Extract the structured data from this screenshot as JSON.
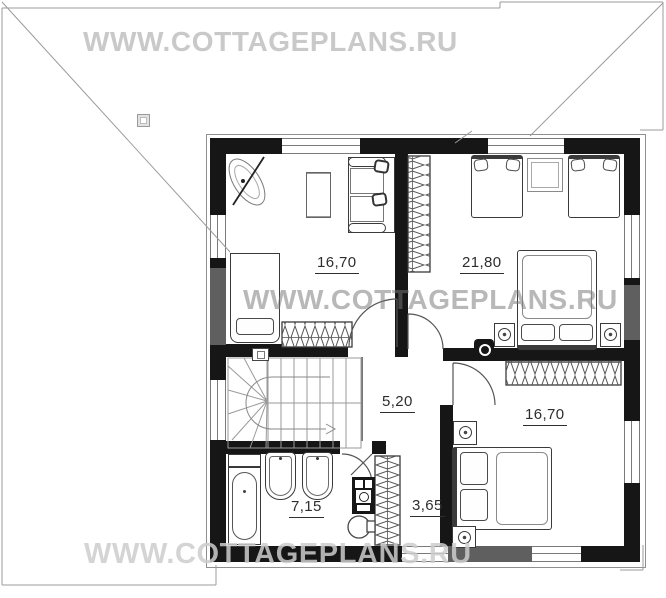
{
  "watermark": {
    "text": "WWW.COTTAGEPLANS.RU"
  },
  "rooms": {
    "living": {
      "area": "16,70"
    },
    "nursery": {
      "area": "21,80"
    },
    "hall": {
      "area": "5,20"
    },
    "bedroom": {
      "area": "16,70"
    },
    "bathroom": {
      "area": "7,15"
    },
    "closet": {
      "area": "3,65"
    }
  },
  "colors": {
    "wall": "#161616",
    "lower_floor_wall": "#5f5f5f",
    "watermark_gray": "#c9c9c9"
  }
}
